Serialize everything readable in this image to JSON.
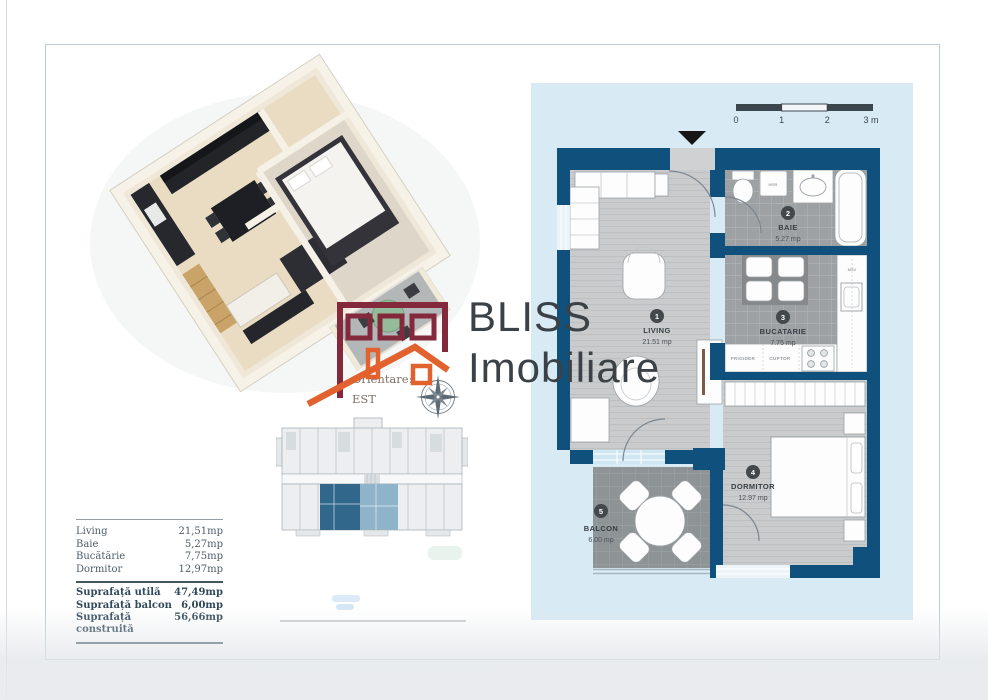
{
  "brand": {
    "name_top": "BLISS",
    "name_bottom": "Imobiliare"
  },
  "orientation": {
    "label": "Orientare:",
    "value": "EST"
  },
  "scale_bar": {
    "t0": "0",
    "t1": "1",
    "t2": "2",
    "t3": "3 m"
  },
  "plan": {
    "rooms": [
      {
        "no": "1",
        "name": "LIVING",
        "area": "21.51 mp"
      },
      {
        "no": "2",
        "name": "BAIE",
        "area": "5.27 mp"
      },
      {
        "no": "3",
        "name": "BUCATARIE",
        "area": "7.75 mp"
      },
      {
        "no": "4",
        "name": "DORMITOR",
        "area": "12.97 mp"
      },
      {
        "no": "5",
        "name": "BALCON",
        "area": "6.00 mp"
      }
    ],
    "appliances": {
      "fridge": "FRIGIDER",
      "oven": "CUPTOR",
      "washer": "MSR",
      "dishwasher": "MSV"
    }
  },
  "area_table": {
    "rows": [
      {
        "label": "Living",
        "value": "21,51mp"
      },
      {
        "label": "Baie",
        "value": "5,27mp"
      },
      {
        "label": "Bucătărie",
        "value": "7,75mp"
      },
      {
        "label": "Dormitor",
        "value": "12,97mp"
      }
    ],
    "totals": [
      {
        "label": "Suprafață utilă",
        "value": "47,49mp"
      },
      {
        "label": "Suprafață balcon",
        "value": "6,00mp"
      },
      {
        "label": "Suprafață construită",
        "value": "56,66mp"
      }
    ]
  },
  "colors": {
    "wall": "#10507d",
    "panel": "#d8eaf4",
    "logo_maroon": "#84293b",
    "logo_orange": "#e2622f"
  }
}
